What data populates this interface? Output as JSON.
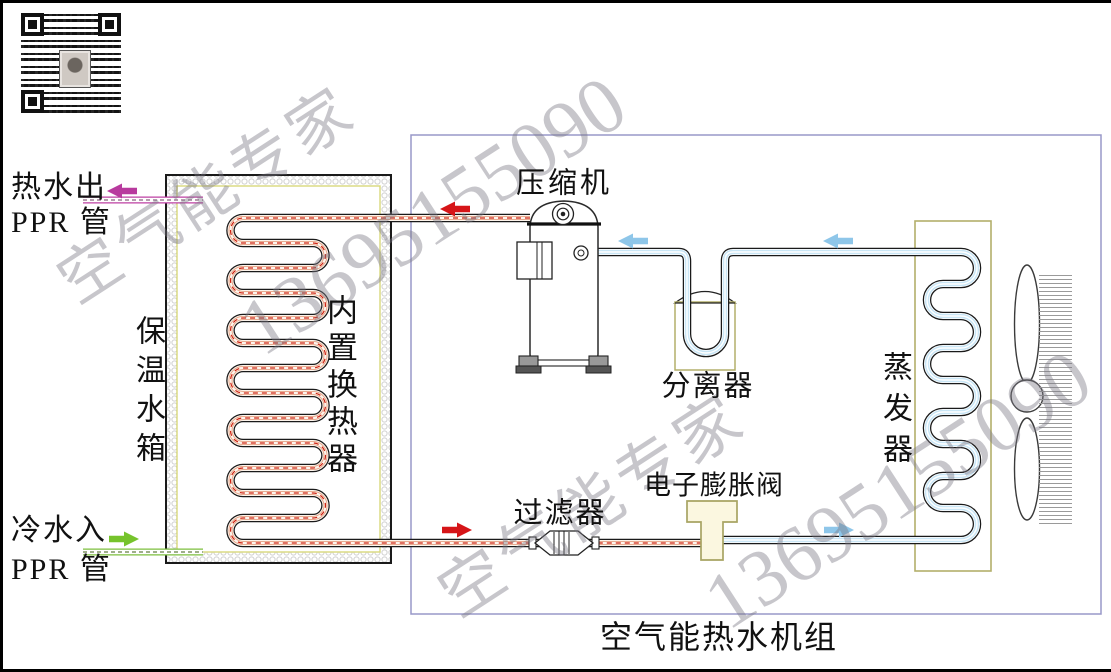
{
  "diagram": {
    "unit_title": "空气能热水机组",
    "labels": {
      "hot_water_out": "热水出",
      "cold_water_in": "冷水入",
      "ppr_pipe": "PPR 管",
      "tank": "保温水箱",
      "inner_coil": "内置换热器",
      "compressor": "压缩机",
      "separator": "分离器",
      "evaporator": "蒸发器",
      "filter": "过滤器",
      "expansion_valve": "电子膨胀阀"
    },
    "watermarks": {
      "brand": "空气能专家",
      "phone": "13695155090"
    },
    "flow_arrows": [
      {
        "name": "hot-water-out-arrow",
        "direction": "left",
        "color": "#b83a9e"
      },
      {
        "name": "discharge-arrow",
        "direction": "left",
        "color": "#d61518"
      },
      {
        "name": "suction-arrow-compressor",
        "direction": "left",
        "color": "#8ec6e9"
      },
      {
        "name": "suction-arrow-evaporator",
        "direction": "left",
        "color": "#8ec6e9"
      },
      {
        "name": "liquid-line-arrow",
        "direction": "right",
        "color": "#d61518"
      },
      {
        "name": "cold-gas-arrow",
        "direction": "right",
        "color": "#8ec6e9"
      },
      {
        "name": "cold-water-in-arrow",
        "direction": "right",
        "color": "#76c32c"
      }
    ],
    "colors": {
      "hot_refrigerant_center": "#cf2010",
      "hot_refrigerant_fill": "#fdf4ec",
      "cold_refrigerant_fill": "#c9e6f6",
      "hot_water_pipe": "#bd3fa3",
      "cold_water_pipe": "#7cbf3e",
      "unit_box_border": "#9898c8",
      "vessel_border": "#b3af6a",
      "watermark_gray": "#c5c3c9"
    }
  }
}
